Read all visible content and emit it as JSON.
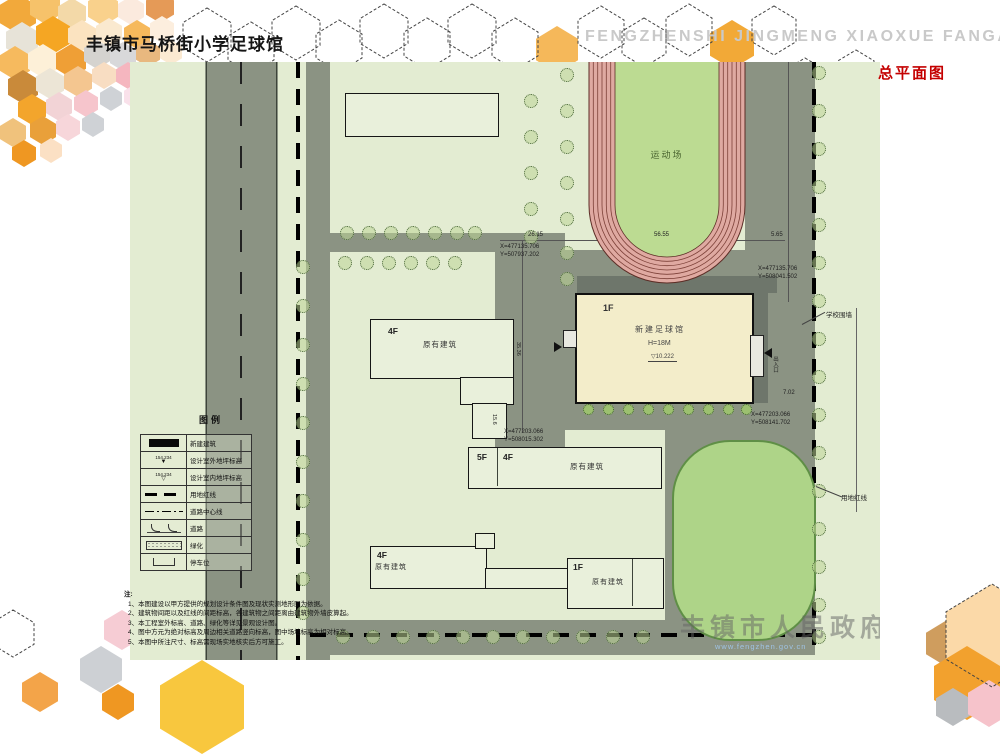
{
  "header": {
    "title_cn": "丰镇市马桥街小学足球馆",
    "title_en": "FENGZHENSHI JINGMENG XIAOXUE FANGAN SHEJI",
    "drawing_label": "总平面图"
  },
  "colors": {
    "accent_red": "#c40000",
    "plan_background": "#e3ecd2",
    "road_gray": "#8b9383",
    "track_pink": "#dfa9a1",
    "infield_green": "#bcdb92",
    "field_green": "#aed488",
    "hall_fill": "#f3edca",
    "hex_orange": "#f5a623"
  },
  "plan": {
    "track_label": "运动场",
    "hall": {
      "floors": "1F",
      "name": "新建足球馆",
      "height": "H=18M",
      "elevation": "10.222"
    },
    "buildings": {
      "left": {
        "floors": "4F",
        "name": "原有建筑"
      },
      "middle": {
        "floors_a": "5F",
        "floors_b": "4F",
        "name": "原有建筑"
      },
      "bottom": {
        "floors": "4F",
        "name": "原有建筑"
      },
      "right": {
        "floors": "1F",
        "name": "原有建筑"
      }
    },
    "annotations": {
      "dim_top_left": "26.15",
      "dim_top_mid": "56.55",
      "dim_top_right": "5.65",
      "dim_right": "7.02",
      "dim_v1": "35.36",
      "dim_v2": "15.6",
      "coord_a_x": "X=477135.706",
      "coord_a_y": "Y=508041.502",
      "coord_b_x": "X=477135.706",
      "coord_b_y": "Y=507937.202",
      "coord_c_x": "X=477203.066",
      "coord_c_y": "Y=508141.702",
      "coord_d_x": "X=477203.066",
      "coord_d_y": "Y=508015.302",
      "boundary_wall": "学校围墙",
      "red_line": "用地红线",
      "entrance": "出入口"
    }
  },
  "legend": {
    "title": "图例",
    "rows": [
      {
        "label": "新建建筑"
      },
      {
        "label": "设计室外地坪标高",
        "value": "154.234"
      },
      {
        "label": "设计室内地坪标高",
        "value": "154.234"
      },
      {
        "label": "用地红线"
      },
      {
        "label": "道路中心线"
      },
      {
        "label": "道路"
      },
      {
        "label": "绿化"
      },
      {
        "label": "停车位"
      }
    ]
  },
  "notes": {
    "title": "注:",
    "items": [
      "1、本图建设以甲方提供的规划设计条件图及现状实测地形图为依据。",
      "2、建筑物间距以及红线的间距标高，各建筑物之间距离由建筑物外墙皮算起。",
      "3、本工程室外标高、道路、绿化等详见景观设计图。",
      "4、图中方元为绝对标高及周边相关道路竖向标高，图中场地标高为相对标高。",
      "5、本图中所注尺寸、标高需现场实地核实后方可施工。"
    ]
  },
  "watermark": {
    "text": "丰镇市人民政府",
    "url": "www.fengzhen.gov.cn"
  }
}
